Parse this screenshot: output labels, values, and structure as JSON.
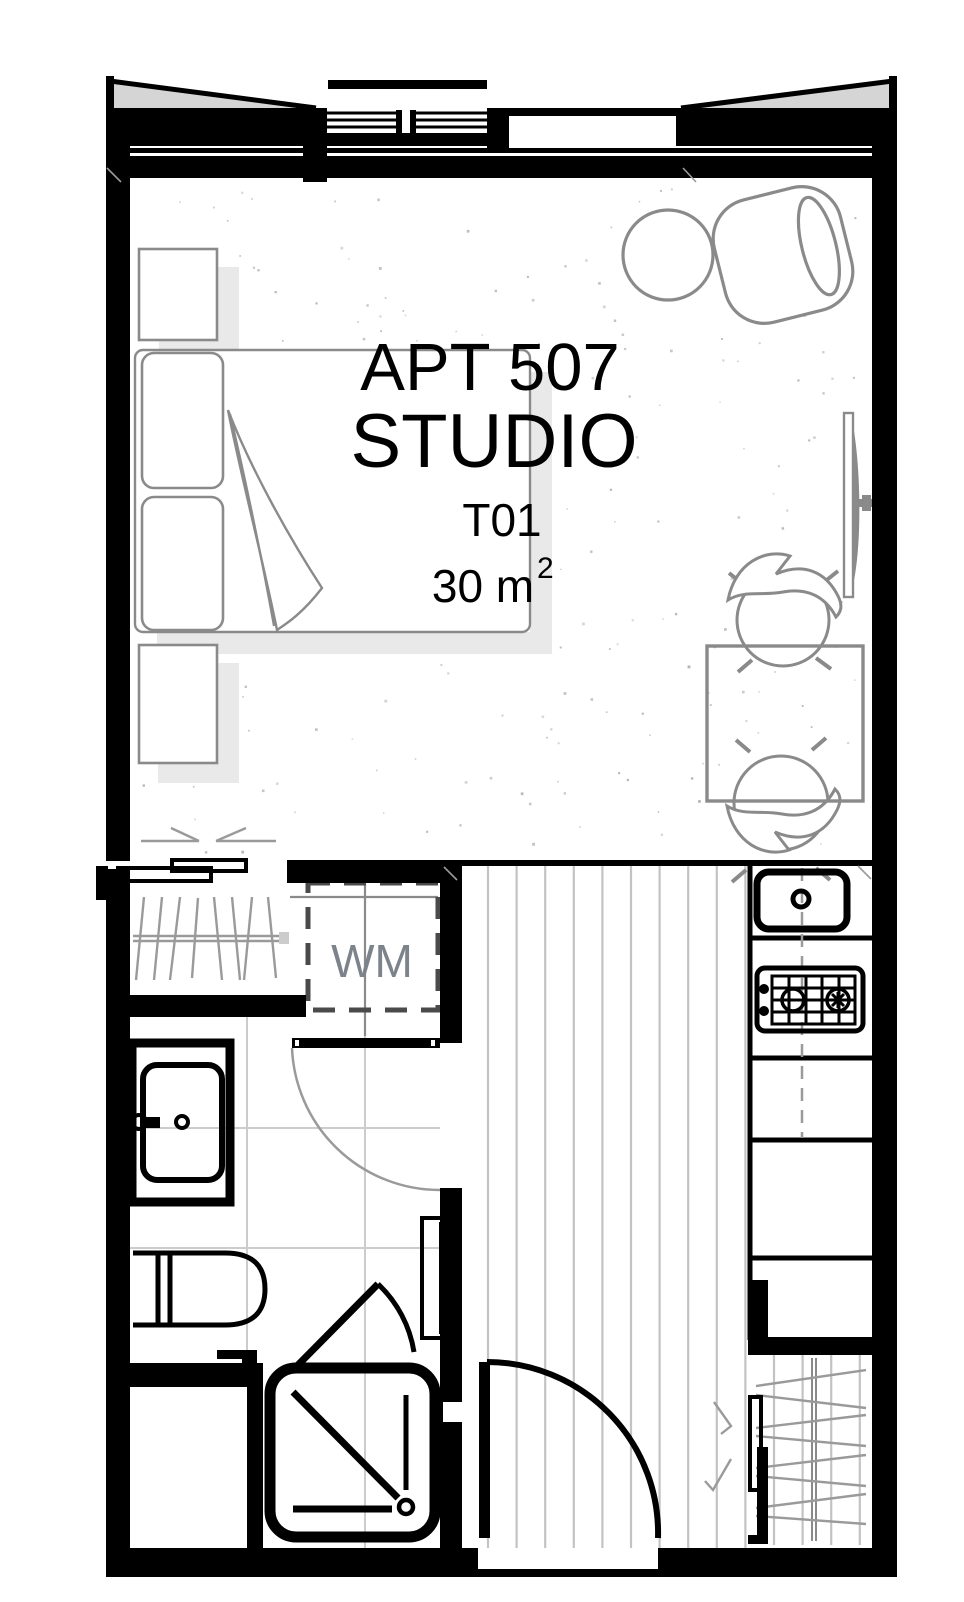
{
  "title": {
    "apt": "APT 507",
    "type": "STUDIO",
    "unit": "T01",
    "area": "30 m",
    "area_sup": "2"
  },
  "labels": {
    "washing_machine": "WM"
  },
  "colors": {
    "wall": "#000000",
    "furniture": "#8a8a8a",
    "shadow": "#e9e9e9",
    "bay": "#d5d5d5",
    "tile": "#cccccc",
    "plank": "#c3c3c3",
    "hatch": "#9a9a9a",
    "wm_dash": "#4a4a4a",
    "wm_text": "#7d838b",
    "text": "#000000"
  }
}
